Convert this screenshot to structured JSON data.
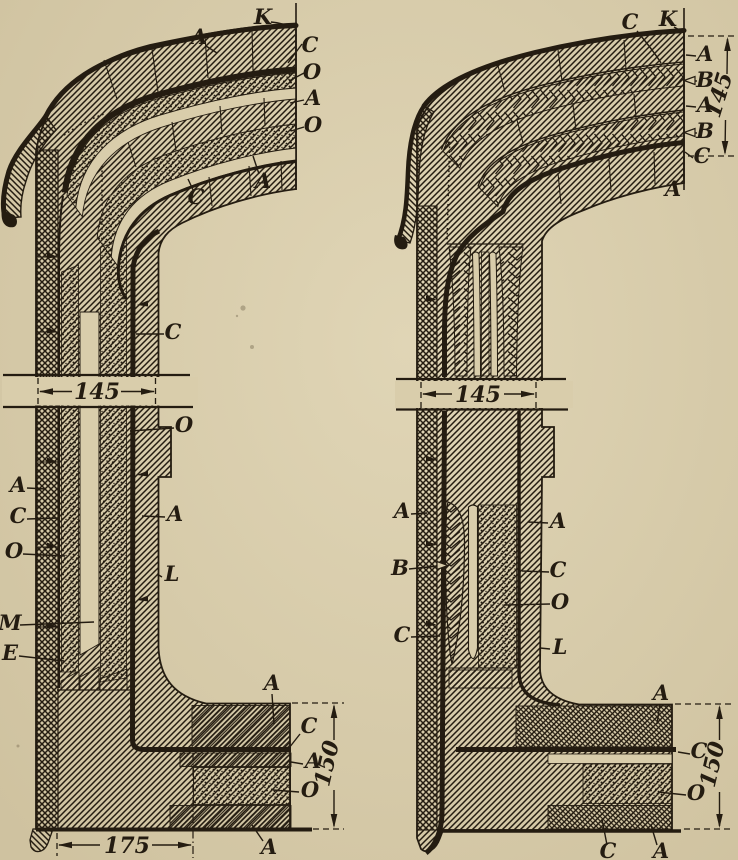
{
  "figure_type": "engineering-cross-section",
  "paper_color": "#d9cdab",
  "ink_color": "#241c11",
  "views": {
    "left": {
      "labels": {
        "k": "K",
        "a_top": "A",
        "c_cut": "C",
        "o_cut1": "O",
        "a_cut": "A",
        "o_cut2": "O",
        "a_under": "A",
        "c_under": "C",
        "c_wall": "C",
        "o_ledge": "O",
        "a_outer": "A",
        "c_shell": "C",
        "o_fill": "O",
        "a_inner": "A",
        "l_face": "L",
        "m_col": "M",
        "e_col": "E",
        "a_floor": "A",
        "c_floor": "C",
        "a_floor2": "A",
        "o_floor": "O",
        "a_floor3": "A"
      },
      "dims": {
        "wall": "145",
        "width": "175",
        "height": "150"
      }
    },
    "right": {
      "labels": {
        "c_top": "C",
        "k": "K",
        "a1": "A",
        "b1": "B",
        "a2": "A",
        "b2": "B",
        "c_cut": "C",
        "a_under": "A",
        "a_outer": "A",
        "b_leaf": "B",
        "c_shell": "C",
        "a_inner": "A",
        "c_col": "C",
        "o_fill": "O",
        "l_face": "L",
        "a_floor": "A",
        "c_floor": "C",
        "o_floor": "O",
        "c_floor2": "C",
        "a_floor2": "A"
      },
      "dims": {
        "stack": "145",
        "wall": "145",
        "height": "150"
      }
    }
  }
}
